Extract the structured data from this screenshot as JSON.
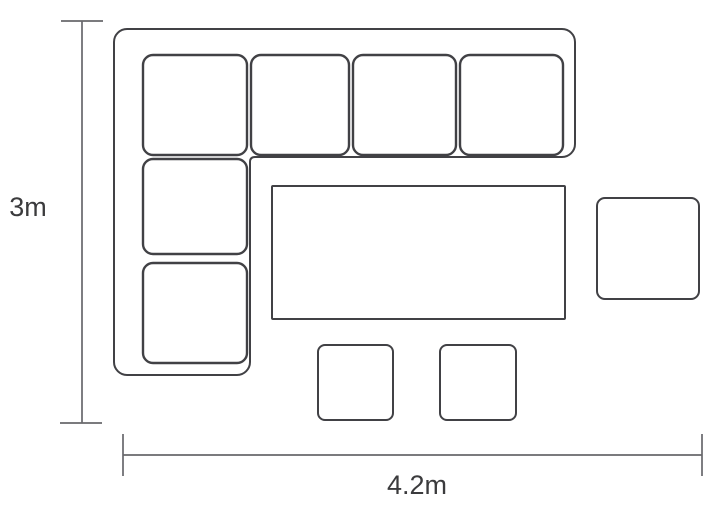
{
  "diagram": {
    "type": "furniture-layout-floor-plan",
    "colors": {
      "furniture_line": "#414145",
      "dimension_line": "#68686c",
      "label_text": "#3b3b3d",
      "background": "#ffffff"
    },
    "dimensions": {
      "height": {
        "label": "3m"
      },
      "width": {
        "label": "4.2m"
      }
    },
    "items": [
      {
        "name": "corner-sofa-outline"
      },
      {
        "name": "sofa-seat-cushions",
        "count": 6
      },
      {
        "name": "dining-table"
      },
      {
        "name": "side-table-right"
      },
      {
        "name": "stool-bottom-left"
      },
      {
        "name": "stool-bottom-right"
      }
    ]
  }
}
